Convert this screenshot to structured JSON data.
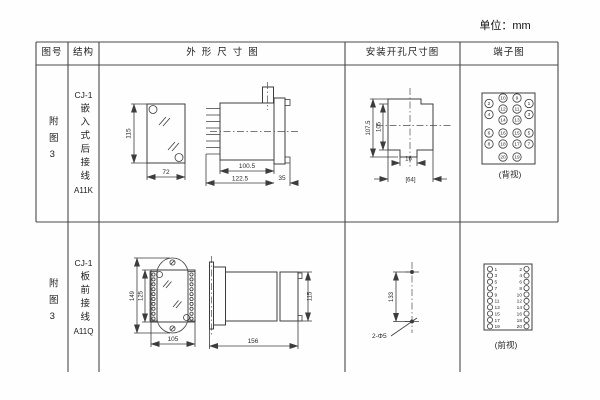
{
  "unit": "单位：mm",
  "headers": {
    "fig": "图号",
    "structure": "结构",
    "outline": "外形尺寸图",
    "mounting": "安装开孔尺寸图",
    "terminal": "端子图"
  },
  "rows": [
    {
      "fig": "附图3",
      "model": "CJ-1",
      "mount_type": "嵌入式后接线",
      "code": "A11K",
      "outline": {
        "front_height": "115",
        "front_width": "72",
        "body_len": "100.5",
        "total_len": "122.5",
        "flange": "35"
      },
      "cutout": {
        "outer_h": "107.5",
        "inner_h": "105",
        "notch": "16",
        "width": "[64]"
      },
      "terminal": {
        "view": "(背视)",
        "numbers": [
          "10",
          "9",
          "2",
          "1",
          "12",
          "11",
          "4",
          "3",
          "14",
          "13",
          "16",
          "15",
          "6",
          "5",
          "18",
          "17",
          "8",
          "7",
          "20",
          "19"
        ]
      }
    },
    {
      "fig": "附图3",
      "model": "CJ-1",
      "mount_type": "板前接线",
      "code": "A11Q",
      "outline": {
        "outer_h": "149",
        "inner_h": "125",
        "width": "105",
        "side_h": "115",
        "total_len": "156"
      },
      "holes": {
        "spacing": "133",
        "label": "2-Φ5"
      },
      "terminal": {
        "view": "(前视)",
        "left": [
          "1",
          "3",
          "5",
          "7",
          "9",
          "11",
          "13",
          "15",
          "17",
          "19"
        ],
        "right": [
          "2",
          "4",
          "6",
          "8",
          "10",
          "12",
          "14",
          "16",
          "18",
          "20"
        ]
      }
    }
  ]
}
